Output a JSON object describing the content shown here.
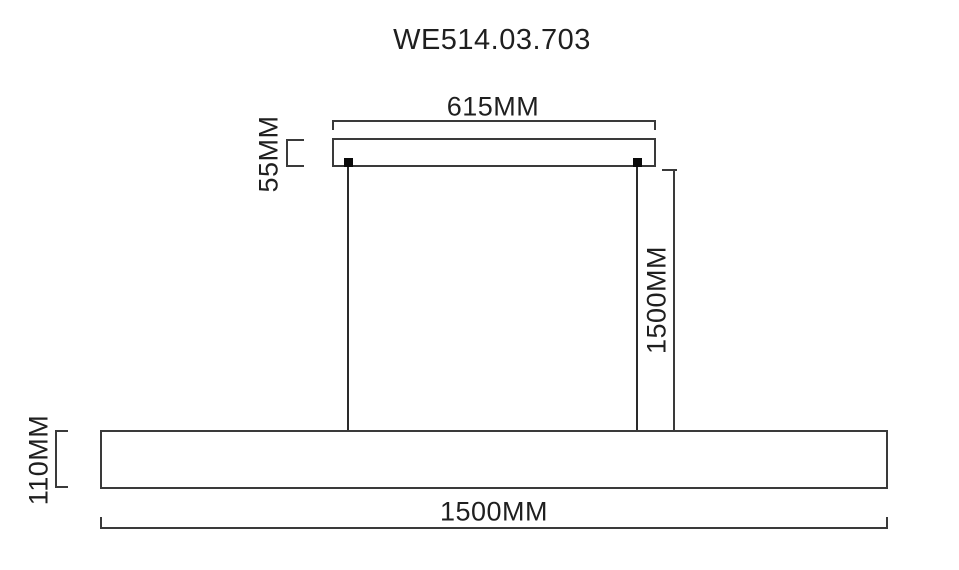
{
  "title": "WE514.03.703",
  "dimensions": {
    "canopy_width": {
      "label": "615MM"
    },
    "canopy_height": {
      "label": "55MM"
    },
    "suspension_length": {
      "label": "1500MM"
    },
    "fixture_height": {
      "label": "110MM"
    },
    "fixture_width": {
      "label": "1500MM"
    }
  },
  "colors": {
    "line": "#3a3a3a",
    "text": "#1f1f1f",
    "mount": "#0a0a0a",
    "background": "#ffffff"
  }
}
